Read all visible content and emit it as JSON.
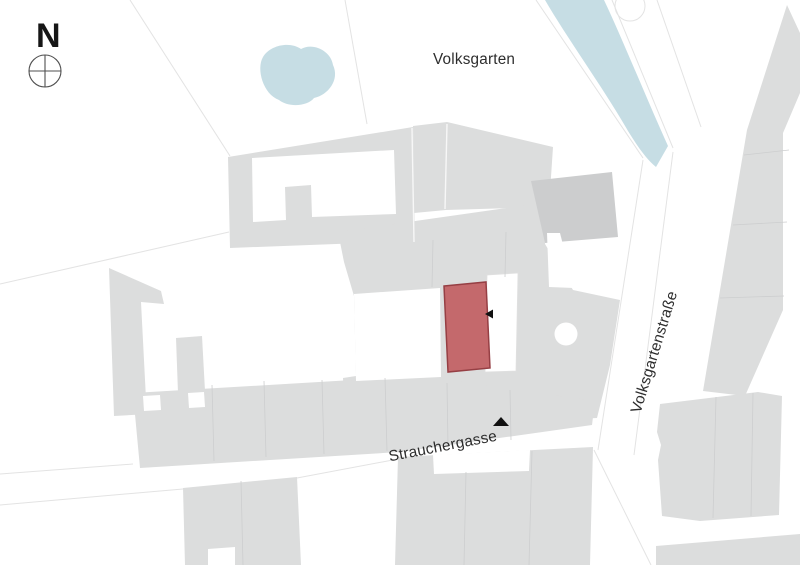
{
  "map": {
    "region_labels": {
      "park": "Volksgarten"
    },
    "street_labels": {
      "south": "Strauchergasse",
      "east": "Volksgartenstraße"
    },
    "compass": {
      "north_letter": "N"
    },
    "colors": {
      "building": "#dcdddd",
      "building_dark": "#cccdce",
      "water": "#c6dde4",
      "site_fill": "#c4696c",
      "site_outline": "#963f44",
      "parcel_line": "#e3e3e3",
      "divider_line": "#cdcecf",
      "marker": "#111111",
      "label_text": "#2d2d2d"
    },
    "markers": {
      "east_marker": "triangle-left",
      "south_marker": "triangle-up"
    }
  }
}
